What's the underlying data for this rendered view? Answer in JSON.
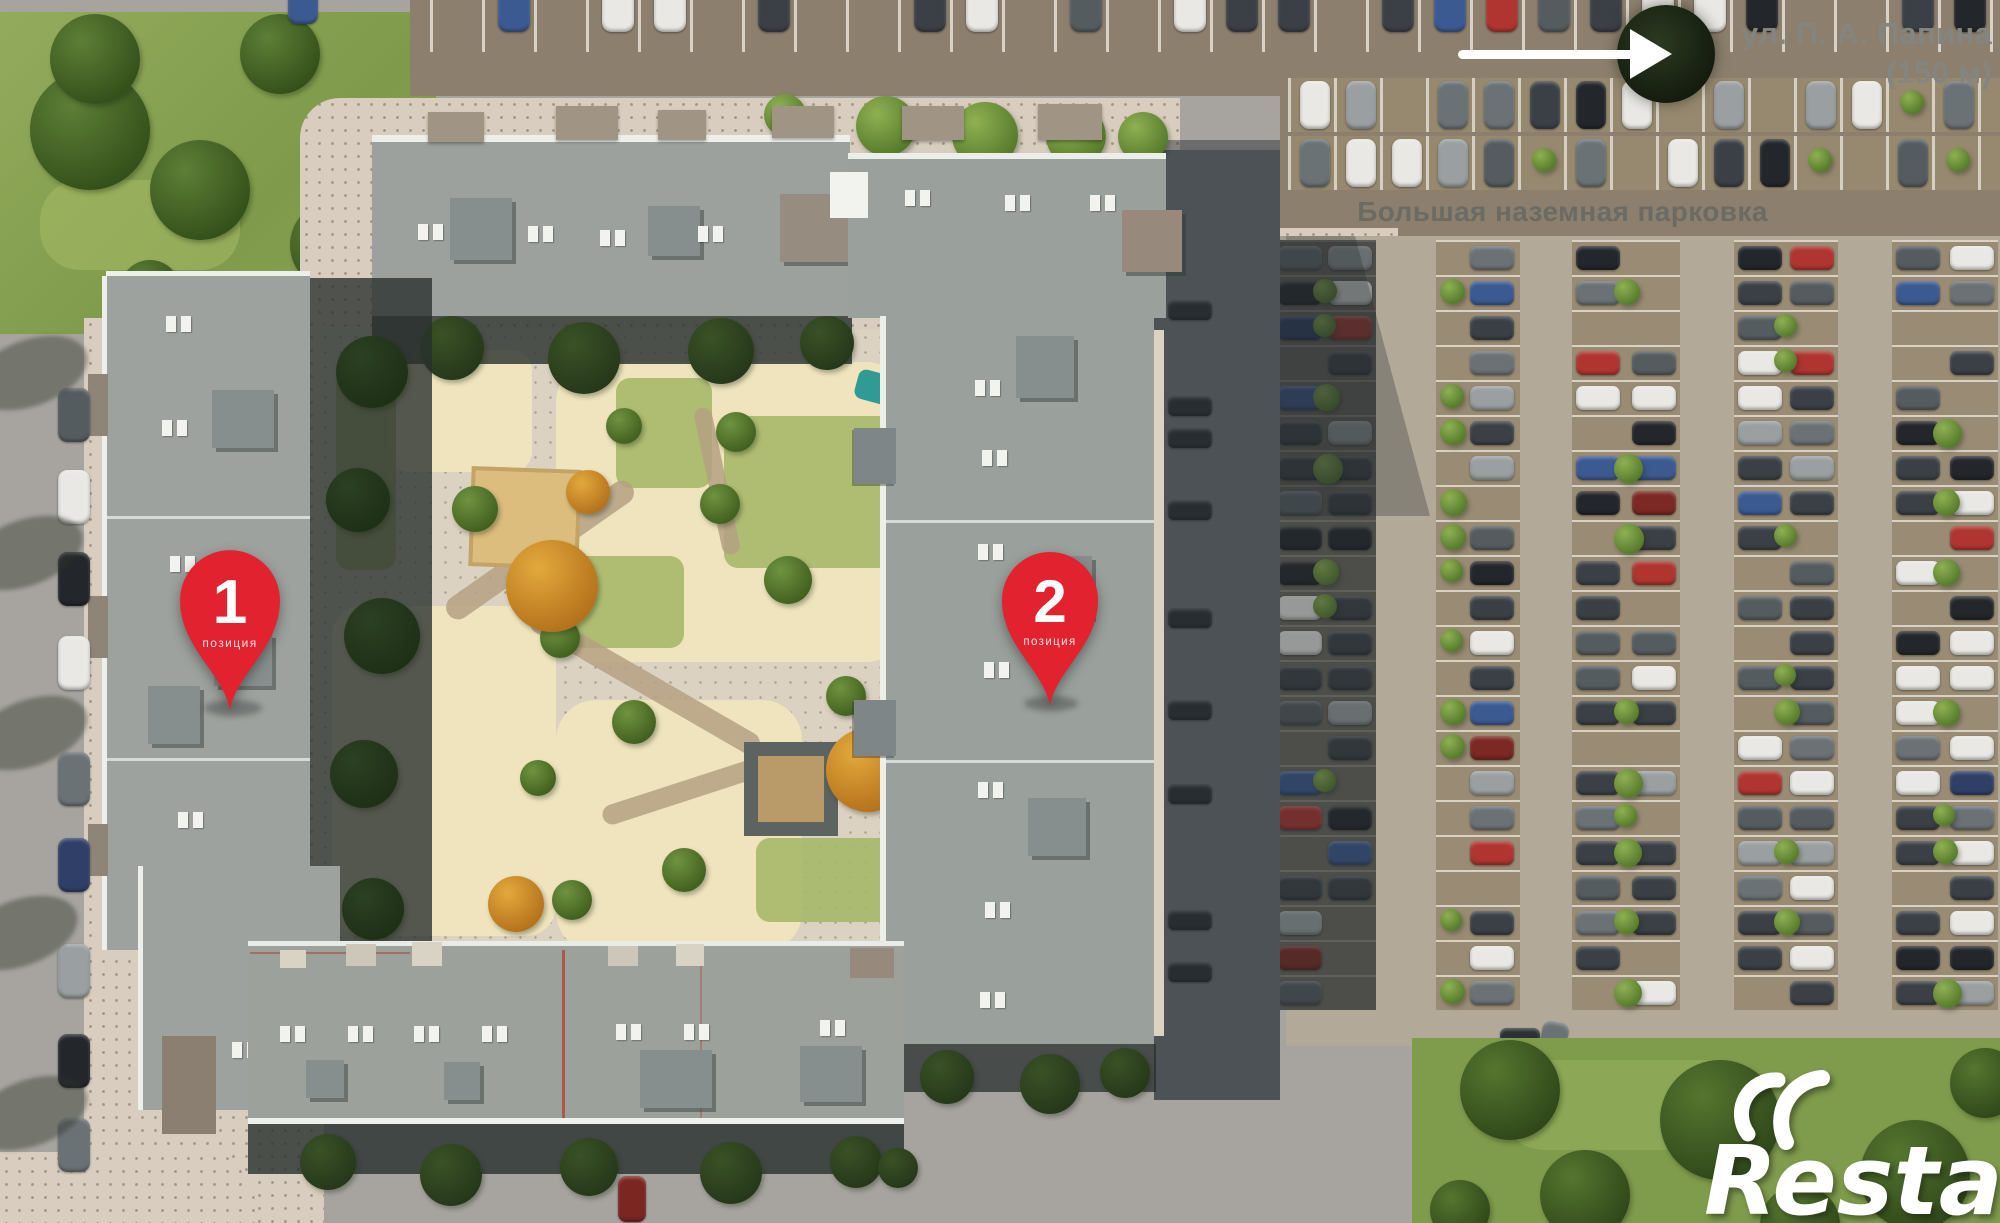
{
  "map": {
    "street_sign": {
      "name": "ул. П. А. Папина",
      "distance": "(150 м)"
    },
    "parking_label": "Большая наземная парковка",
    "pins": [
      {
        "number": "1",
        "caption": "позиция"
      },
      {
        "number": "2",
        "caption": "позиция"
      }
    ],
    "watermark": "Restate",
    "icons": {
      "arrow": "arrow-right-icon"
    },
    "colors": {
      "pin": "#e2222f",
      "street_label": "#85857f",
      "parking_label": "#6b6b64",
      "watermark": "#ffffff"
    }
  }
}
